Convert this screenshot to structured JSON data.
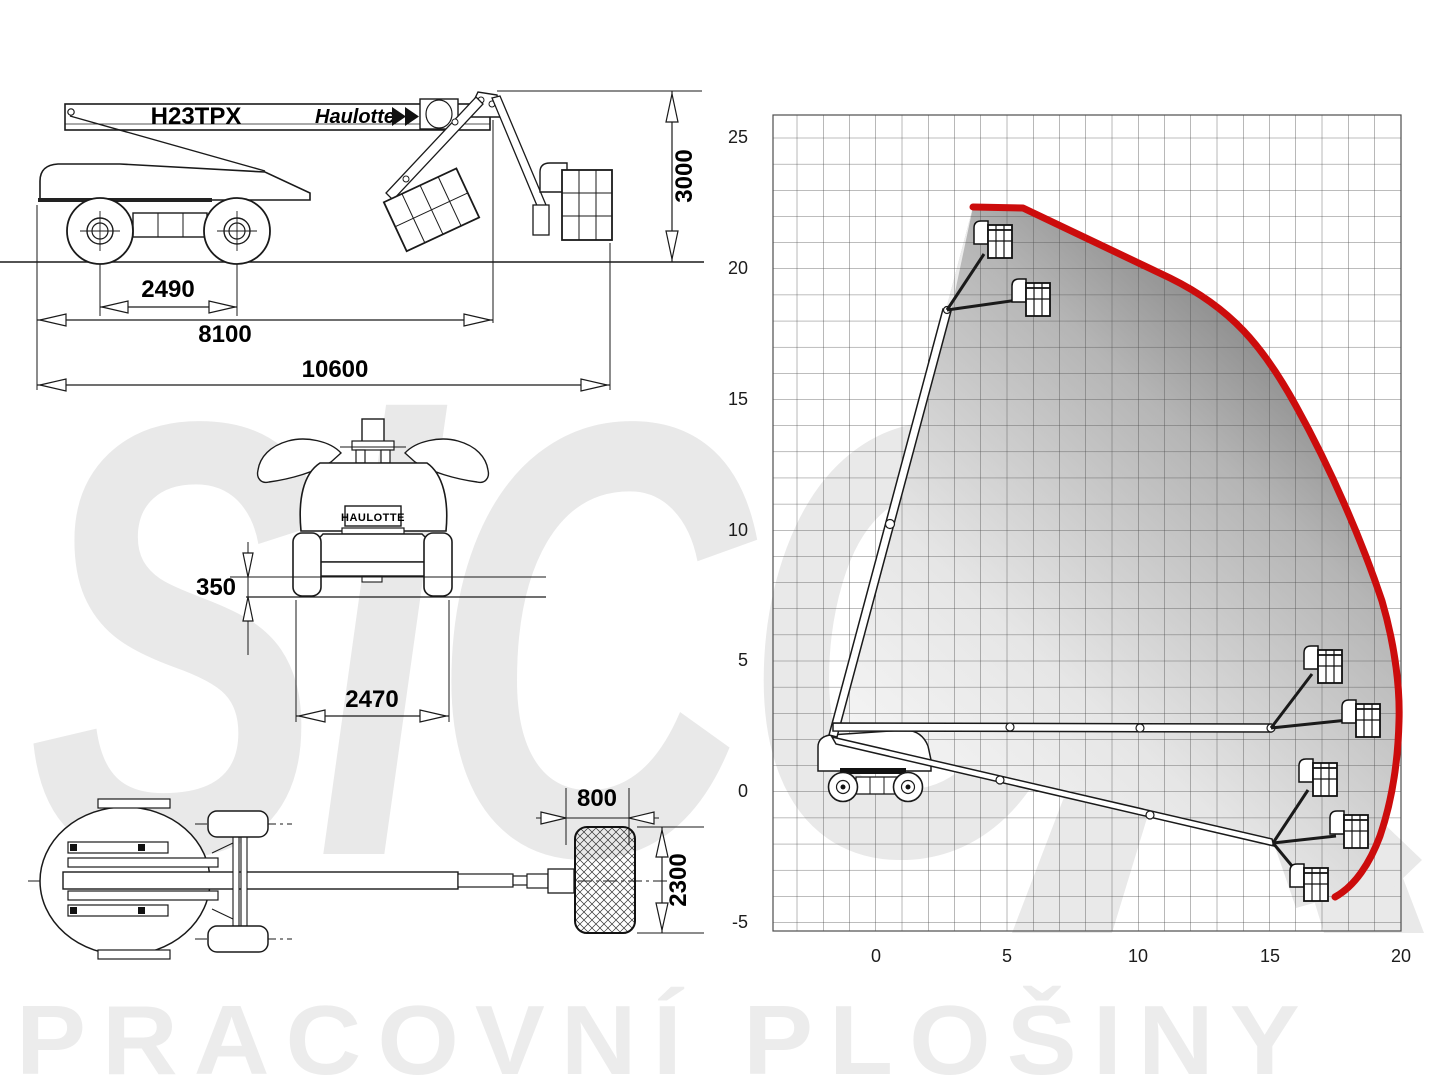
{
  "brand": {
    "model": "H23TPX",
    "name": "Haulotte"
  },
  "side_view": {
    "dim_wheelbase": "2490",
    "dim_pivot_length": "8100",
    "dim_total_length": "10600",
    "dim_height": "3000"
  },
  "front_view": {
    "plate": "HAULOTTE",
    "dim_clearance": "350",
    "dim_width": "2470"
  },
  "top_view": {
    "dim_platform_width": "800",
    "dim_platform_length": "2300"
  },
  "chart": {
    "y_ticks": [
      "25",
      "20",
      "15",
      "10",
      "5",
      "0",
      "-5"
    ],
    "x_ticks": [
      "0",
      "5",
      "10",
      "15",
      "20"
    ],
    "envelope_color": "#cc0c0c"
  },
  "watermark": {
    "logo": "SiCO",
    "bottom_text": "PRACOVNÍ PLOŠINY"
  },
  "chart_data": {
    "type": "area",
    "title": "H23TPX working envelope",
    "x_ticks": [
      0,
      5,
      10,
      15,
      20
    ],
    "y_ticks": [
      25,
      20,
      15,
      10,
      5,
      0,
      -5
    ],
    "x_range": [
      -4,
      20
    ],
    "y_range": [
      -5.5,
      26
    ],
    "grid": true,
    "units": "m",
    "max_platform_height_m": 22.3,
    "max_outreach_m": 19.8,
    "envelope_boundary_m": [
      [
        -1.6,
        2.2
      ],
      [
        3.7,
        22.3
      ],
      [
        5.6,
        22.3
      ],
      [
        11.2,
        19.6
      ],
      [
        13.2,
        17.5
      ],
      [
        15.2,
        15.4
      ],
      [
        17.1,
        12.6
      ],
      [
        18.3,
        10.0
      ],
      [
        19.2,
        7.7
      ],
      [
        19.8,
        4.5
      ],
      [
        19.8,
        3.0
      ],
      [
        19.5,
        0.0
      ],
      [
        19.2,
        -1.4
      ],
      [
        18.8,
        -2.6
      ],
      [
        17.9,
        -3.8
      ],
      [
        17.5,
        -3.9
      ],
      [
        15.2,
        -1.9
      ]
    ],
    "machine_positions_m": [
      {
        "boom": "raised",
        "basket_at": [
          4.2,
          21.0
        ]
      },
      {
        "boom": "raised-jib-horizontal",
        "basket_at": [
          5.8,
          18.8
        ]
      },
      {
        "boom": "horizontal-jib-up",
        "basket_at": [
          16.8,
          5.0
        ]
      },
      {
        "boom": "horizontal",
        "basket_at": [
          18.4,
          2.8
        ]
      },
      {
        "boom": "lowered-jib-up",
        "basket_at": [
          16.6,
          0.4
        ]
      },
      {
        "boom": "lowered",
        "basket_at": [
          17.9,
          -1.5
        ]
      },
      {
        "boom": "lowered-jib-down",
        "basket_at": [
          16.4,
          -3.6
        ]
      }
    ]
  }
}
